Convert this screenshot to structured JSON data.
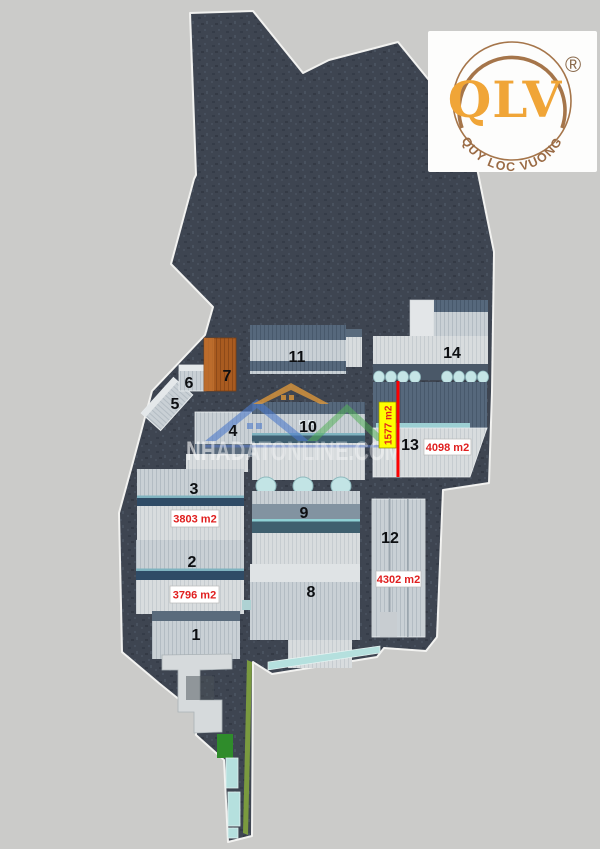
{
  "logo": {
    "brand": "QLV",
    "registered_mark": "®",
    "tagline": "QUY LOC VUONG",
    "brand_color": "#f0a537",
    "ring_color": "#9a6b45"
  },
  "watermark": {
    "text": "NHADATONLINE.COM",
    "houses": [
      "orange-house",
      "blue-house",
      "green-house"
    ]
  },
  "buildings": [
    {
      "number": "1"
    },
    {
      "number": "2",
      "area": "3796 m2"
    },
    {
      "number": "3",
      "area": "3803 m2"
    },
    {
      "number": "4"
    },
    {
      "number": "5"
    },
    {
      "number": "6"
    },
    {
      "number": "7"
    },
    {
      "number": "8"
    },
    {
      "number": "9"
    },
    {
      "number": "10"
    },
    {
      "number": "11"
    },
    {
      "number": "12",
      "area": "4302 m2"
    },
    {
      "number": "13",
      "area": "4098 m2",
      "highlight_area": "1577 m2"
    },
    {
      "number": "14"
    }
  ],
  "colors": {
    "background": "#cbcbc9",
    "land": "#3e4551",
    "roof_light": "#c9d0d5",
    "roof_dark_band": "#51647a",
    "ridge_teal": "#7fb3c0",
    "building7_orange": "#a95b20",
    "highlight_yellow": "#ffff00",
    "area_text_red": "#e01f1f",
    "measure_line_red": "#fe0000",
    "teal_building": "#b5e0de",
    "grass_green": "#2f8c2b"
  }
}
